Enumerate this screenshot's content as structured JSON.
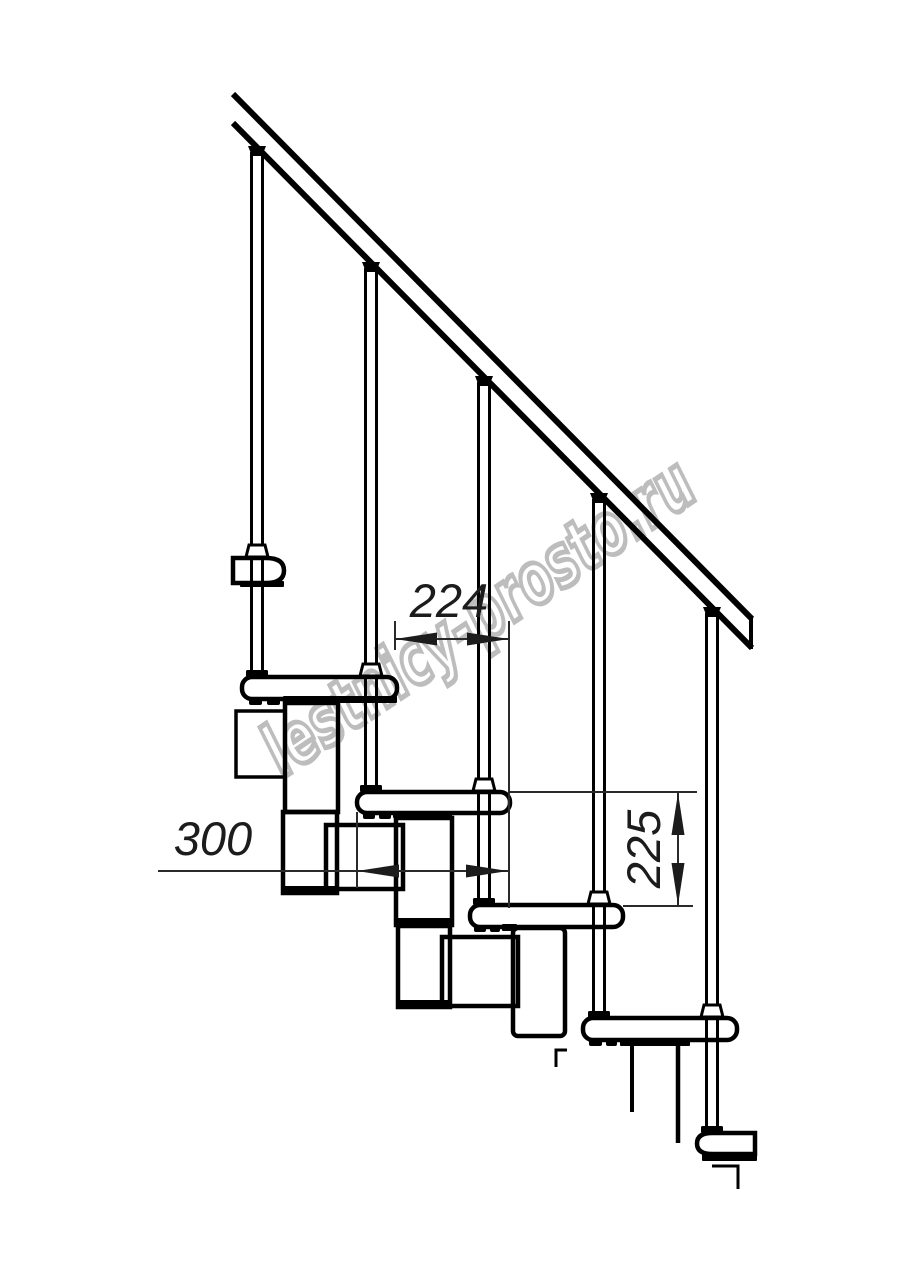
{
  "drawing": {
    "type": "modular staircase side elevation",
    "ink_color": "#000000",
    "background_color": "#ffffff",
    "dim_color": "#2a2a2a"
  },
  "dimensions": {
    "tread_run": {
      "value": "224"
    },
    "tread_depth": {
      "value": "300"
    },
    "riser_height": {
      "value": "225"
    }
  },
  "watermark": {
    "text": "lestnicy-prosto.ru",
    "color": "#bdbdbd"
  }
}
